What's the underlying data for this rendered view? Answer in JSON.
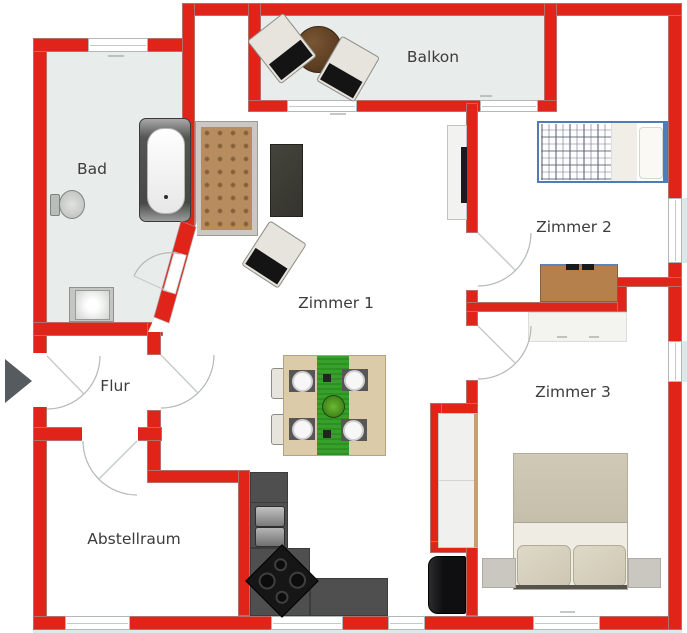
{
  "rooms": {
    "bad": {
      "label": "Bad"
    },
    "flur": {
      "label": "Flur"
    },
    "abstellraum": {
      "label": "Abstellraum"
    },
    "zimmer1": {
      "label": "Zimmer 1"
    },
    "zimmer2": {
      "label": "Zimmer 2"
    },
    "zimmer3": {
      "label": "Zimmer 3"
    },
    "balkon": {
      "label": "Balkon"
    }
  },
  "palette": {
    "wall_red": "#e02419",
    "wet_room_floor": "#e8eceb",
    "room_floor": "#ffffff",
    "door_arc": "#b4b8b8",
    "label_text": "#3c3c3c",
    "bed_frame_blue": "#4e7cb8",
    "table_runner_green": "#36a02a",
    "sofa_brown": "#b78d60",
    "kitchen_counter_gray": "#4f4f4f",
    "desk_wood": "#b5804c",
    "entry_arrow": "#565b60"
  },
  "furniture": [
    "bathtub",
    "toilet",
    "washbasin",
    "sofa",
    "side-table",
    "chair",
    "tv-sideboard",
    "dining-table",
    "dining-chairs",
    "kitchen-counter",
    "kitchen-sink",
    "cooktop",
    "refrigerator",
    "single-bed",
    "desk",
    "wardrobe",
    "closet",
    "double-bed",
    "nightstands",
    "balcony-table",
    "balcony-chairs"
  ],
  "entry": {
    "side": "left",
    "direction": "right"
  }
}
